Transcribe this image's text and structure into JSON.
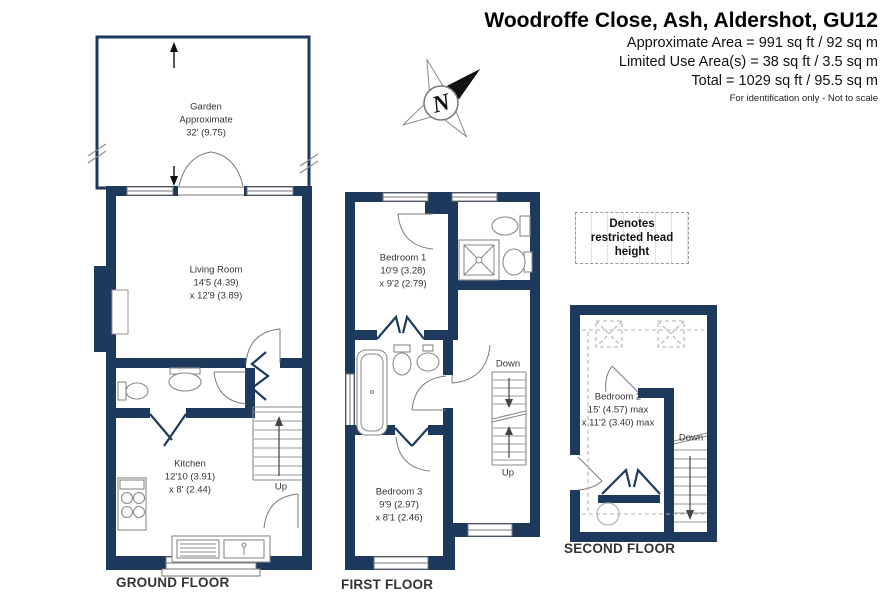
{
  "header": {
    "title": "Woodroffe Close, Ash, Aldershot, GU12",
    "line1": "Approximate Area = 991 sq ft / 92 sq m",
    "line2": "Limited Use Area(s) = 38 sq ft / 3.5 sq m",
    "line3": "Total = 1029 sq ft / 95.5 sq m",
    "disclaimer": "For identification only - Not to scale"
  },
  "compass": {
    "north_label": "N"
  },
  "legend": {
    "text": "Denotes restricted head height"
  },
  "floors": {
    "ground": {
      "label": "GROUND FLOOR",
      "rooms": {
        "garden": {
          "name": "Garden",
          "dim1": "Approximate",
          "dim2": "32' (9.75)"
        },
        "living_room": {
          "name": "Living Room",
          "dim1": "14'5 (4.39)",
          "dim2": "x 12'9 (3.89)"
        },
        "kitchen": {
          "name": "Kitchen",
          "dim1": "12'10 (3.91)",
          "dim2": "x 8' (2.44)"
        }
      },
      "stair_labels": {
        "up": "Up"
      }
    },
    "first": {
      "label": "FIRST FLOOR",
      "rooms": {
        "bedroom1": {
          "name": "Bedroom 1",
          "dim1": "10'9 (3.28)",
          "dim2": "x 9'2 (2.79)"
        },
        "bedroom3": {
          "name": "Bedroom 3",
          "dim1": "9'9 (2.97)",
          "dim2": "x 8'1 (2.46)"
        }
      },
      "stair_labels": {
        "down": "Down",
        "up": "Up"
      }
    },
    "second": {
      "label": "SECOND FLOOR",
      "rooms": {
        "bedroom2": {
          "name": "Bedroom 2",
          "dim1": "15' (4.57) max",
          "dim2": "x 11'2 (3.40) max"
        }
      },
      "stair_labels": {
        "down": "Down"
      }
    }
  },
  "colors": {
    "wall": "#1d3a5c",
    "text": "#3a3a3a"
  }
}
